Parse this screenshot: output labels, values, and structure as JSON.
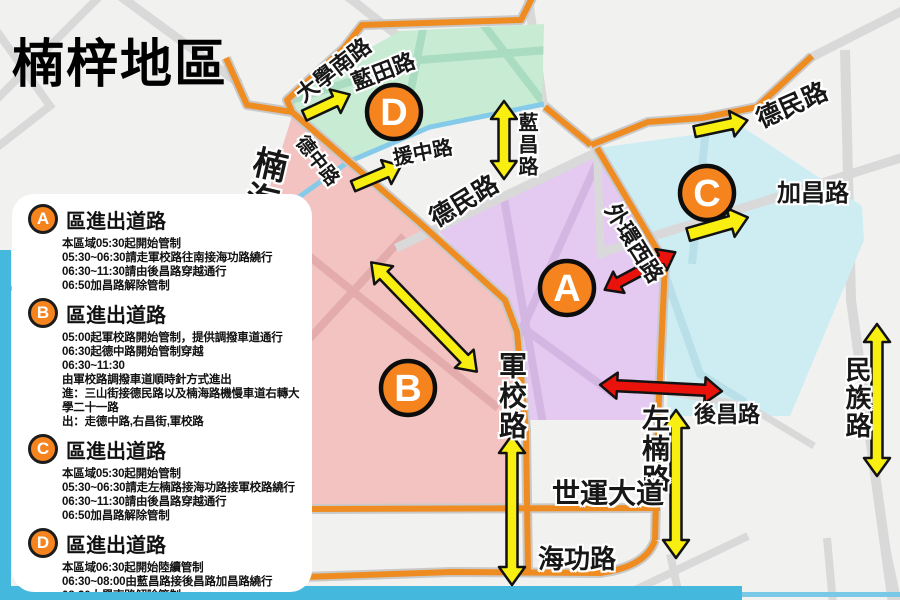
{
  "title": "楠梓地區",
  "zones": [
    {
      "letter": "A"
    },
    {
      "letter": "B"
    },
    {
      "letter": "C"
    },
    {
      "letter": "D"
    }
  ],
  "roads": {
    "daxue_south": "大學南路",
    "lantian": "藍田路",
    "dezhong": "德中路",
    "yuanzhong": "援中路",
    "lanchang": "藍昌路",
    "nanhai": "楠海路",
    "demin_mid": "德民路",
    "demin_ne": "德民路",
    "waihuan_west": "外環西路",
    "jiachang": "加昌路",
    "junxiao": "軍校路",
    "zuonan": "左楠路",
    "houchang": "後昌路",
    "minzu": "民族路",
    "shiyun": "世運大道",
    "haigong": "海功路"
  },
  "panel": {
    "sections": [
      {
        "letter": "A",
        "heading": "區進出道路",
        "lines": [
          "本區域05:30起開始管制",
          "05:30~06:30請走軍校路往南接海功路繞行",
          "06:30~11:30請由後昌路穿越通行",
          "06:50加昌路解除管制"
        ]
      },
      {
        "letter": "B",
        "heading": "區進出道路",
        "lines": [
          "05:00起軍校路開始管制，提供調撥車道通行",
          "06:30起德中路開始管制穿越",
          "06:30~11:30",
          "由軍校路調撥車道順時針方式進出",
          "進：三山街接德民路以及楠海路機慢車道右轉大學二十一路",
          "出：走德中路,右昌街,軍校路"
        ]
      },
      {
        "letter": "C",
        "heading": "區進出道路",
        "lines": [
          "本區域05:30起開始管制",
          "05:30~06:30請走左楠路接海功路接軍校路繞行",
          "06:30~11:30請由後昌路穿越通行",
          "06:50加昌路解除管制"
        ]
      },
      {
        "letter": "D",
        "heading": "區進出道路",
        "lines": [
          "本區域06:30起開始陸續管制",
          "06:30~08:00由藍昌路接後昌路加昌路繞行",
          "08:30大學南路解除管制"
        ]
      }
    ]
  },
  "colors": {
    "marker_orange": "#f5831e",
    "route_orange": "#ee8c22",
    "zone_a_purple": "#e4c9f0",
    "zone_b_pink": "#f2c3c0",
    "zone_c_cyan": "#cdedf3",
    "zone_d_green": "#c7ebd3",
    "arrow_yellow": "#f8ee0f",
    "arrow_red": "#e9130b",
    "water_blue": "#45b9dd"
  }
}
